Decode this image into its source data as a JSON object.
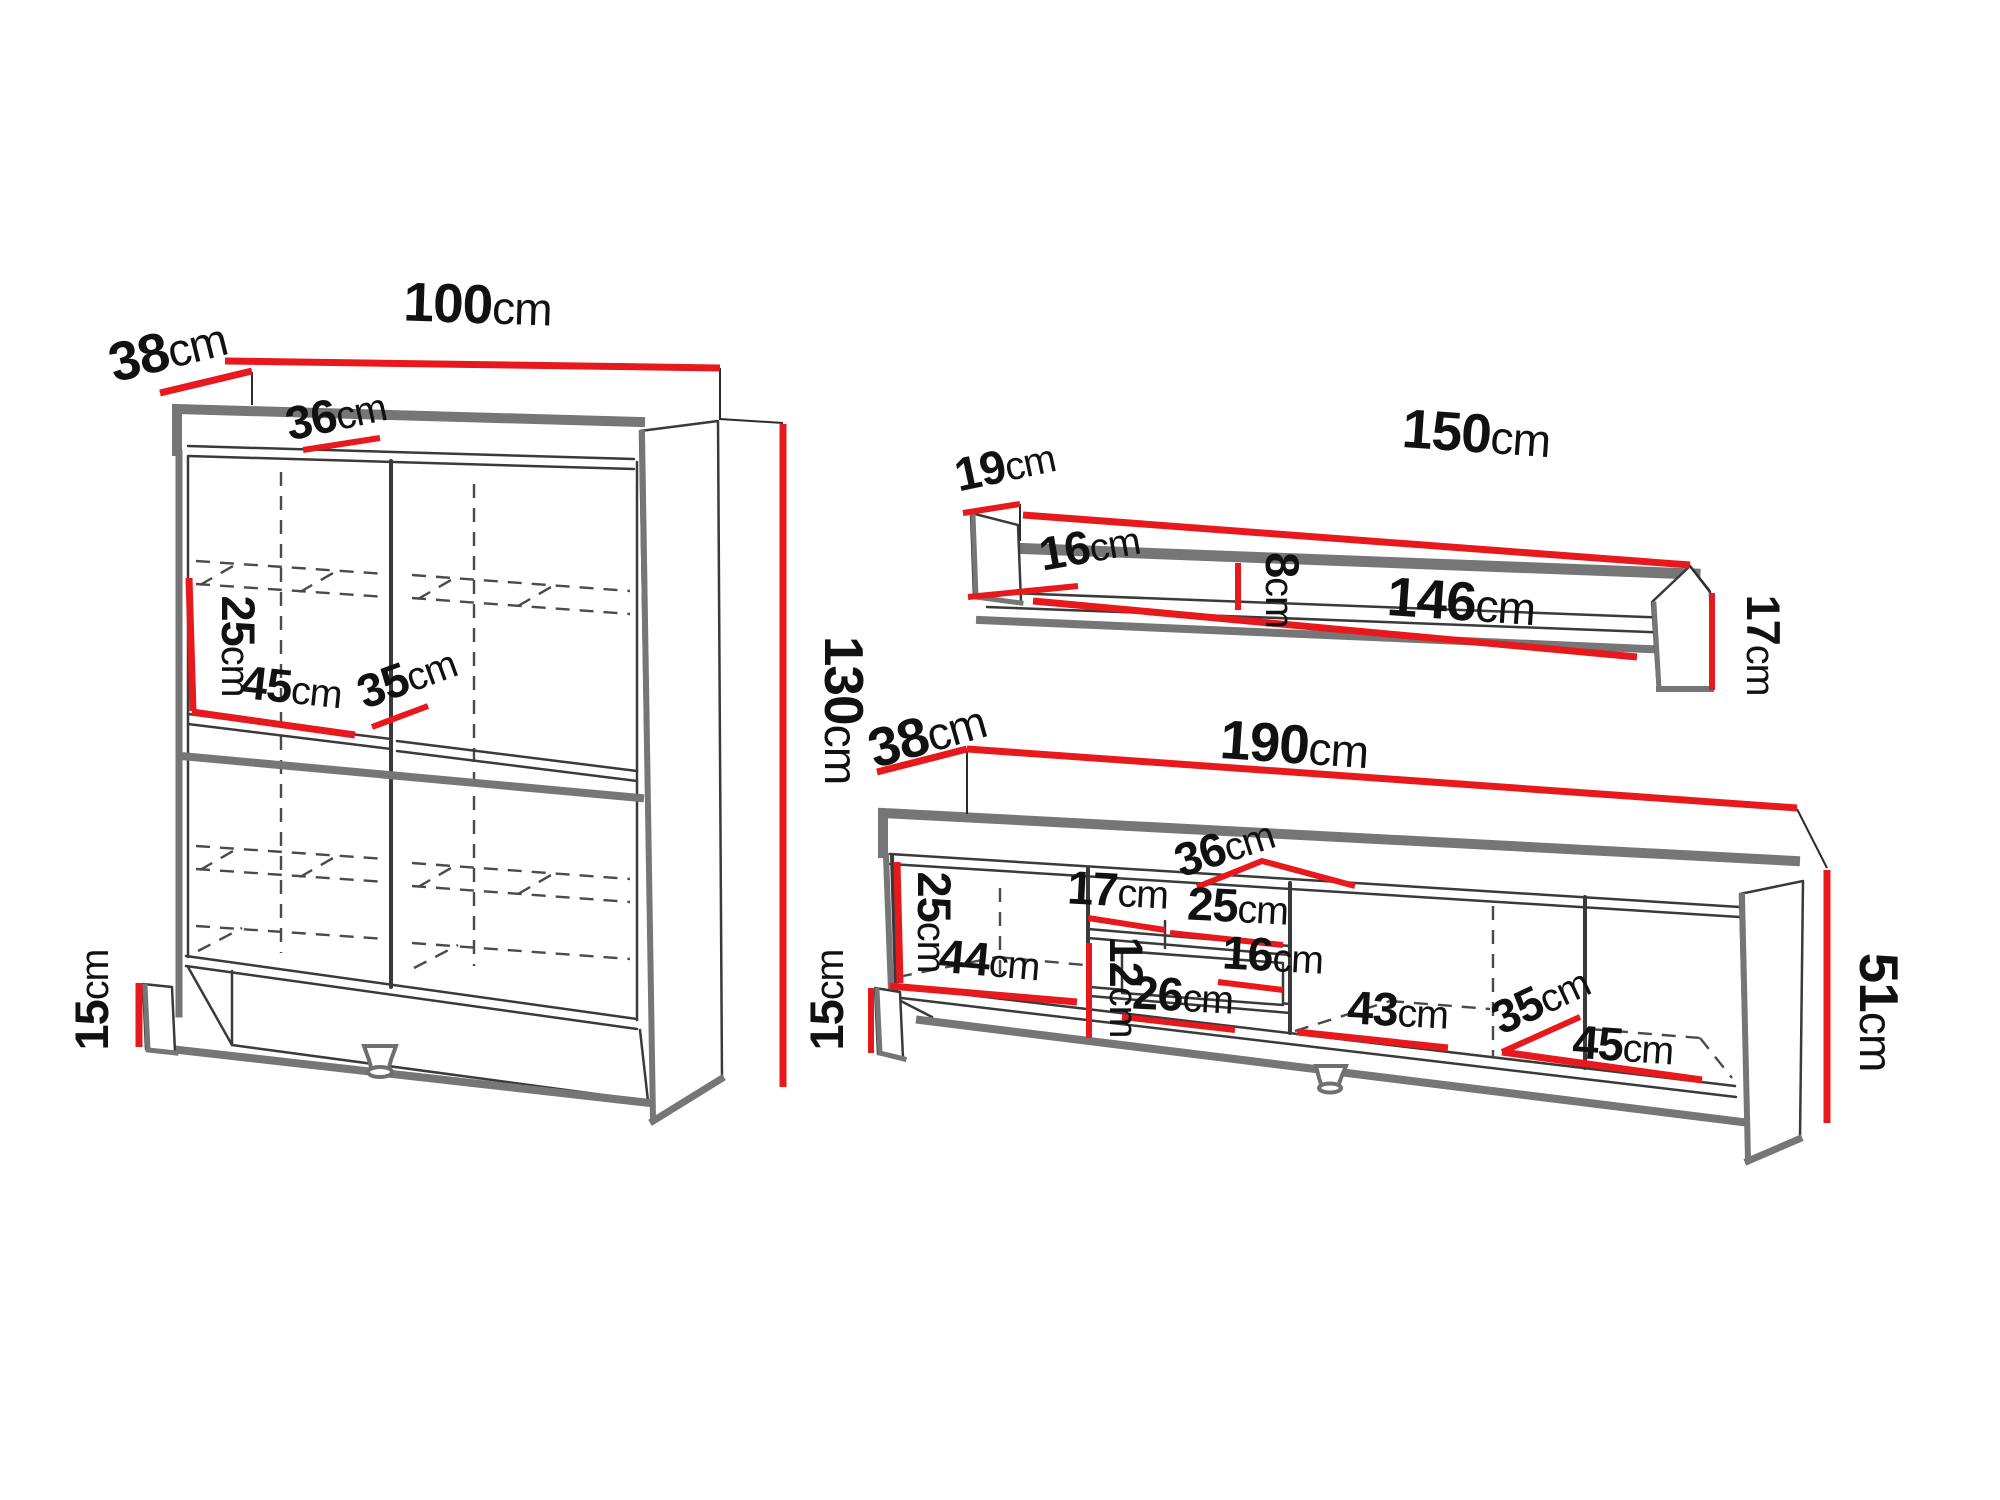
{
  "diagram_title": "furniture-dimensions-diagram",
  "colors": {
    "dimension_red": "#e8191d",
    "outline_dark": "#3a3a3a",
    "shadow_gray": "#767676",
    "background": "#ffffff"
  },
  "furniture": {
    "cabinet": {
      "dims": {
        "depth": {
          "v": "38",
          "u": "cm"
        },
        "width": {
          "v": "100",
          "u": "cm"
        },
        "inner_depth": {
          "v": "36",
          "u": "cm"
        },
        "shelf_height": {
          "v": "25",
          "u": "cm"
        },
        "left_width": {
          "v": "45",
          "u": "cm"
        },
        "shelf_depth": {
          "v": "35",
          "u": "cm"
        },
        "height": {
          "v": "130",
          "u": "cm"
        },
        "plinth": {
          "v": "15",
          "u": "cm"
        }
      }
    },
    "wall_shelf": {
      "dims": {
        "depth": {
          "v": "19",
          "u": "cm"
        },
        "width": {
          "v": "150",
          "u": "cm"
        },
        "inner_depth": {
          "v": "16",
          "u": "cm"
        },
        "inner_height": {
          "v": "8",
          "u": "cm"
        },
        "inner_width": {
          "v": "146",
          "u": "cm"
        },
        "height": {
          "v": "17",
          "u": "cm"
        }
      }
    },
    "tv_stand": {
      "dims": {
        "depth": {
          "v": "38",
          "u": "cm"
        },
        "width": {
          "v": "190",
          "u": "cm"
        },
        "inner_depth": {
          "v": "36",
          "u": "cm"
        },
        "inner_height": {
          "v": "25",
          "u": "cm"
        },
        "plinth": {
          "v": "15",
          "u": "cm"
        },
        "left_width": {
          "v": "44",
          "u": "cm"
        },
        "niche_top": {
          "v": "17",
          "u": "cm"
        },
        "niche_width": {
          "v": "25",
          "u": "cm"
        },
        "niche_inner": {
          "v": "16",
          "u": "cm"
        },
        "drawer_height": {
          "v": "12",
          "u": "cm"
        },
        "drawer_width": {
          "v": "26",
          "u": "cm"
        },
        "mid_width": {
          "v": "43",
          "u": "cm"
        },
        "right_depth": {
          "v": "35",
          "u": "cm"
        },
        "right_width": {
          "v": "45",
          "u": "cm"
        },
        "height": {
          "v": "51",
          "u": "cm"
        }
      }
    }
  }
}
